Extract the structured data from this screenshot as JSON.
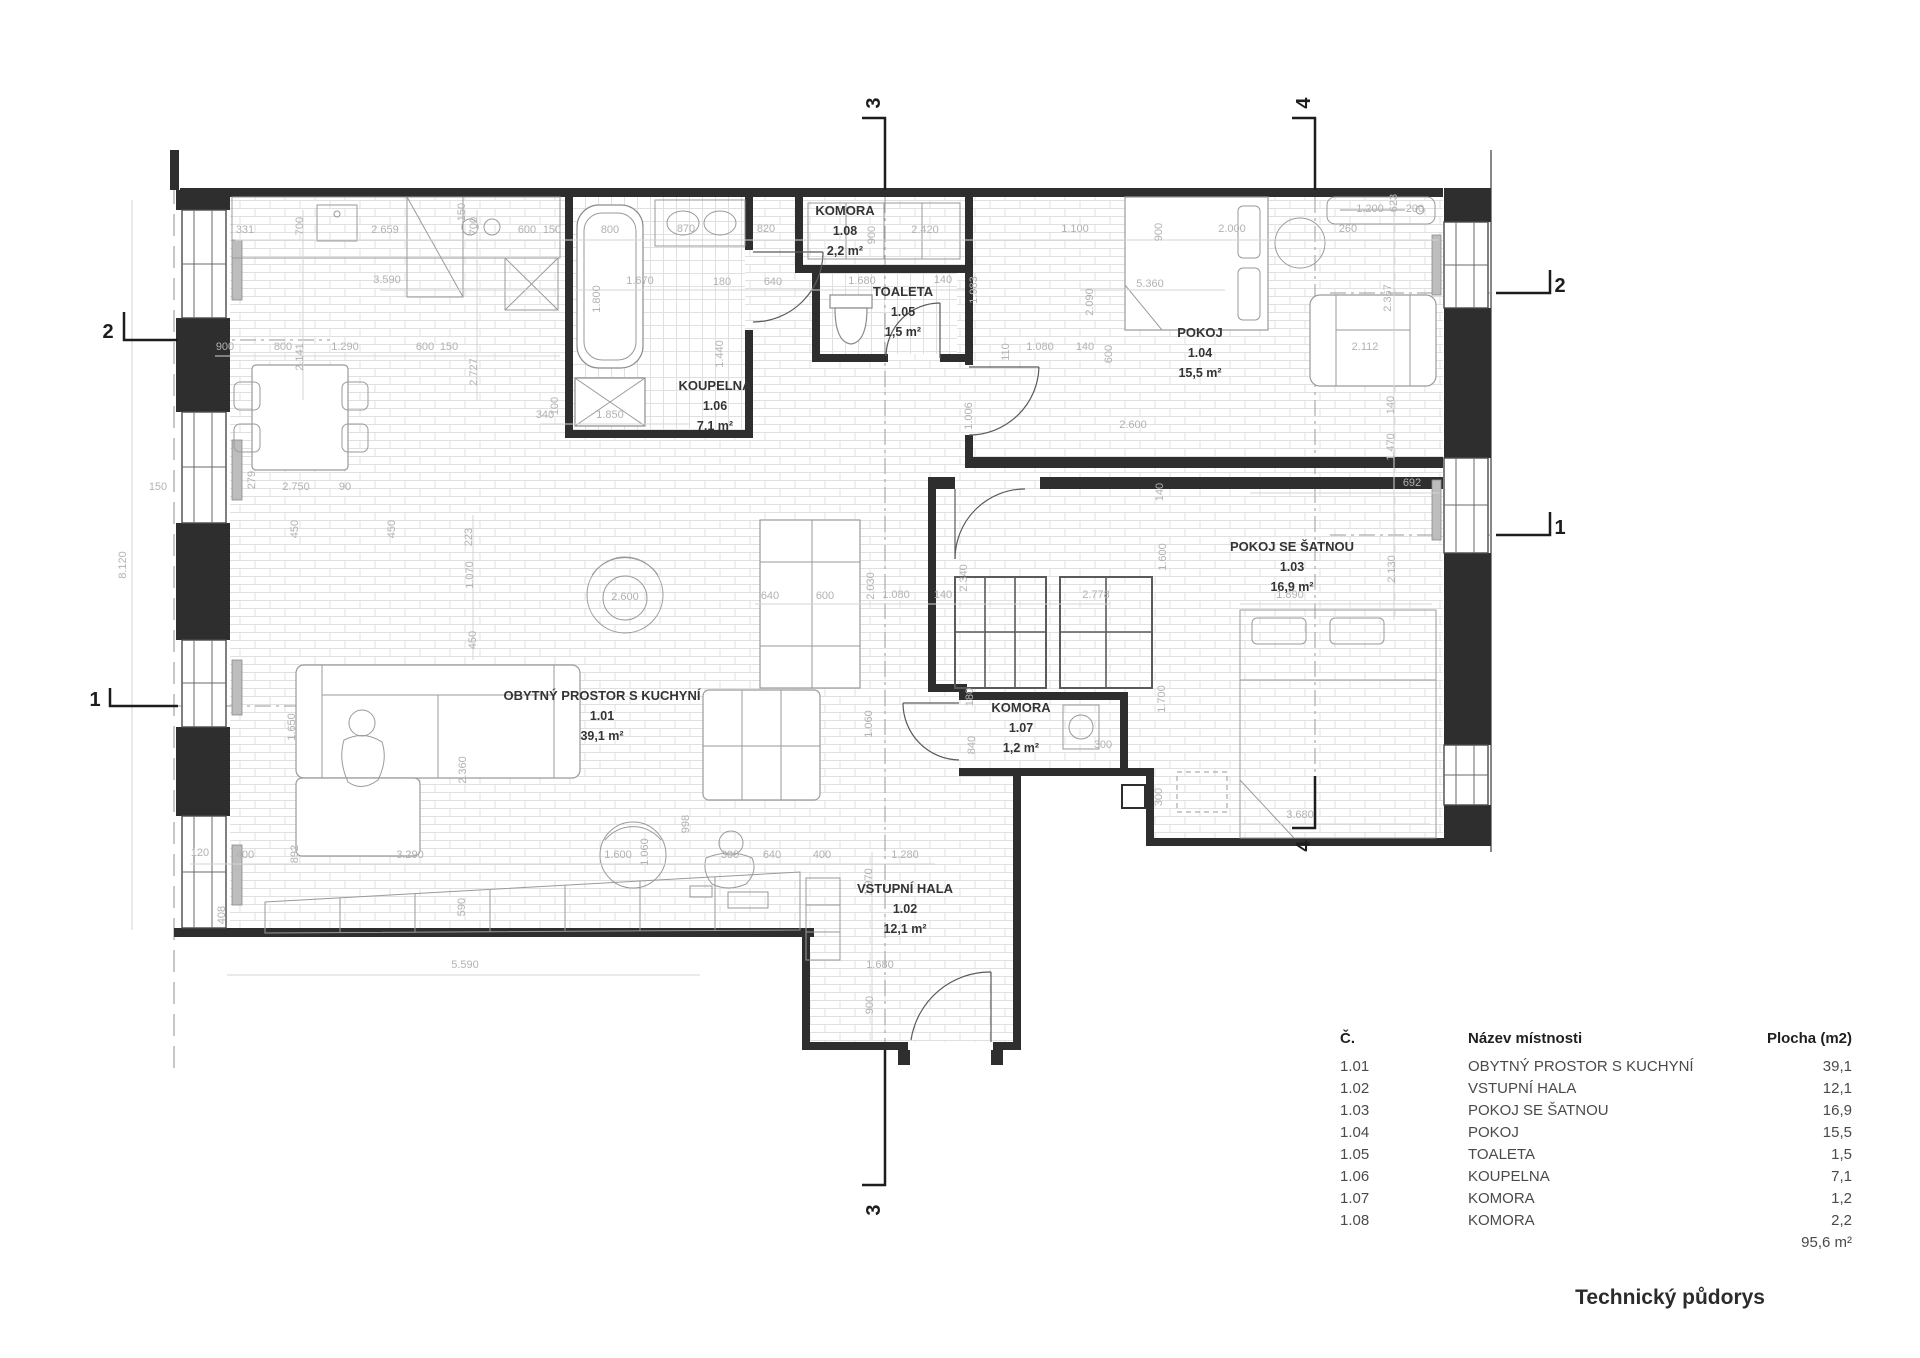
{
  "drawing": {
    "title": "Technický půdorys",
    "total_area": "95,6 m²"
  },
  "legend": {
    "headers": {
      "num": "Č.",
      "name": "Název místnosti",
      "area": "Plocha (m2)"
    },
    "rows": [
      {
        "num": "1.01",
        "name": "OBYTNÝ PROSTOR S KUCHYNÍ",
        "area": "39,1"
      },
      {
        "num": "1.02",
        "name": "VSTUPNÍ HALA",
        "area": "12,1"
      },
      {
        "num": "1.03",
        "name": "POKOJ SE ŠATNOU",
        "area": "16,9"
      },
      {
        "num": "1.04",
        "name": "POKOJ",
        "area": "15,5"
      },
      {
        "num": "1.05",
        "name": "TOALETA",
        "area": "1,5"
      },
      {
        "num": "1.06",
        "name": "KOUPELNA",
        "area": "7,1"
      },
      {
        "num": "1.07",
        "name": "KOMORA",
        "area": "1,2"
      },
      {
        "num": "1.08",
        "name": "KOMORA",
        "area": "2,2"
      }
    ]
  },
  "rooms": [
    {
      "id": "1.01",
      "name": "OBYTNÝ PROSTOR S KUCHYNÍ",
      "area": "39,1 m²",
      "x": 602,
      "y": 700
    },
    {
      "id": "1.02",
      "name": "VSTUPNÍ HALA",
      "area": "12,1 m²",
      "x": 905,
      "y": 893
    },
    {
      "id": "1.03",
      "name": "POKOJ SE ŠATNOU",
      "area": "16,9 m²",
      "x": 1292,
      "y": 551
    },
    {
      "id": "1.04",
      "name": "POKOJ",
      "area": "15,5 m²",
      "x": 1200,
      "y": 337
    },
    {
      "id": "1.05",
      "name": "TOALETA",
      "area": "1,5 m²",
      "x": 903,
      "y": 296
    },
    {
      "id": "1.06",
      "name": "KOUPELNA",
      "area": "7,1 m²",
      "x": 715,
      "y": 390
    },
    {
      "id": "1.07",
      "name": "KOMORA",
      "area": "1,2 m²",
      "x": 1021,
      "y": 712
    },
    {
      "id": "1.08",
      "name": "KOMORA",
      "area": "2,2 m²",
      "x": 845,
      "y": 215
    }
  ],
  "sections": [
    {
      "label": "2",
      "x": 108,
      "y": 338,
      "rot": 0
    },
    {
      "label": "1",
      "x": 95,
      "y": 706,
      "rot": 0
    },
    {
      "label": "2",
      "x": 1560,
      "y": 292,
      "rot": 0
    },
    {
      "label": "1",
      "x": 1560,
      "y": 534,
      "rot": 0
    },
    {
      "label": "3",
      "x": 880,
      "y": 103,
      "rot": 1
    },
    {
      "label": "4",
      "x": 1310,
      "y": 103,
      "rot": 1
    },
    {
      "label": "3",
      "x": 880,
      "y": 1210,
      "rot": 1
    },
    {
      "label": "4",
      "x": 1310,
      "y": 846,
      "rot": 1
    }
  ],
  "dims": [
    [
      "331",
      245,
      233,
      0
    ],
    [
      "700",
      303,
      226,
      1
    ],
    [
      "2.659",
      385,
      233,
      0
    ],
    [
      "700",
      477,
      226,
      1
    ],
    [
      "600",
      527,
      233,
      0
    ],
    [
      "150",
      552,
      233,
      0
    ],
    [
      "800",
      610,
      233,
      0
    ],
    [
      "870",
      686,
      232,
      0
    ],
    [
      "820",
      766,
      232,
      0
    ],
    [
      "900",
      875,
      235,
      1
    ],
    [
      "2.420",
      925,
      233,
      0
    ],
    [
      "1.100",
      1075,
      232,
      0
    ],
    [
      "900",
      1162,
      232,
      1
    ],
    [
      "2.000",
      1232,
      232,
      0
    ],
    [
      "260",
      1348,
      232,
      0
    ],
    [
      "1.200",
      1370,
      212,
      0
    ],
    [
      "623",
      1397,
      203,
      1
    ],
    [
      "200",
      1415,
      212,
      0
    ],
    [
      "3.590",
      387,
      283,
      0
    ],
    [
      "150",
      465,
      212,
      1
    ],
    [
      "1.670",
      640,
      284,
      0
    ],
    [
      "1.800",
      600,
      299,
      1
    ],
    [
      "180",
      722,
      285,
      0
    ],
    [
      "640",
      773,
      285,
      0
    ],
    [
      "1.680",
      862,
      284,
      0
    ],
    [
      "140",
      943,
      283,
      0
    ],
    [
      "1.983",
      977,
      290,
      1
    ],
    [
      "5.360",
      1150,
      287,
      0
    ],
    [
      "2.090",
      1093,
      302,
      1
    ],
    [
      "110",
      1009,
      352,
      1
    ],
    [
      "2.141",
      303,
      357,
      1
    ],
    [
      "2.727",
      477,
      372,
      1
    ],
    [
      "900",
      225,
      350,
      0
    ],
    [
      "800",
      283,
      350,
      0
    ],
    [
      "1.290",
      345,
      350,
      0
    ],
    [
      "600",
      425,
      350,
      0
    ],
    [
      "150",
      449,
      350,
      0
    ],
    [
      "340",
      545,
      418,
      0
    ],
    [
      "100",
      558,
      406,
      1
    ],
    [
      "1.850",
      610,
      418,
      0
    ],
    [
      "1.440",
      723,
      354,
      1
    ],
    [
      "1.080",
      1040,
      350,
      0
    ],
    [
      "140",
      1085,
      350,
      0
    ],
    [
      "600",
      1112,
      354,
      1
    ],
    [
      "2.600",
      1133,
      428,
      0
    ],
    [
      "2.367",
      1391,
      298,
      1
    ],
    [
      "2.112",
      1365,
      350,
      0
    ],
    [
      "140",
      1394,
      405,
      1
    ],
    [
      "150",
      158,
      490,
      0
    ],
    [
      "2.750",
      296,
      490,
      0
    ],
    [
      "279",
      255,
      480,
      1
    ],
    [
      "90",
      345,
      490,
      0
    ],
    [
      "450",
      298,
      529,
      1
    ],
    [
      "450",
      395,
      529,
      1
    ],
    [
      "223",
      472,
      537,
      1
    ],
    [
      "1.070",
      473,
      575,
      1
    ],
    [
      "450",
      476,
      640,
      1
    ],
    [
      "2.600",
      625,
      600,
      0
    ],
    [
      "640",
      770,
      599,
      0
    ],
    [
      "600",
      825,
      599,
      0
    ],
    [
      "2.030",
      874,
      586,
      1
    ],
    [
      "1.080",
      896,
      598,
      0
    ],
    [
      "140",
      943,
      598,
      0
    ],
    [
      "2.778",
      1096,
      598,
      0
    ],
    [
      "2.340",
      967,
      578,
      1
    ],
    [
      "1.006",
      972,
      416,
      1
    ],
    [
      "1.600",
      1166,
      557,
      1
    ],
    [
      "140",
      1163,
      492,
      1
    ],
    [
      "1.470",
      1394,
      447,
      1
    ],
    [
      "692",
      1412,
      486,
      0
    ],
    [
      "1.890",
      1290,
      598,
      0
    ],
    [
      "2.130",
      1395,
      569,
      1
    ],
    [
      "1.700",
      1165,
      699,
      1
    ],
    [
      "8.120",
      126,
      565,
      1
    ],
    [
      "1.650",
      295,
      727,
      1
    ],
    [
      "2.360",
      466,
      770,
      1
    ],
    [
      "1.060",
      648,
      852,
      1
    ],
    [
      "1.060",
      872,
      724,
      1
    ],
    [
      "998",
      689,
      824,
      1
    ],
    [
      "180",
      973,
      697,
      1
    ],
    [
      "840",
      975,
      745,
      1
    ],
    [
      "300",
      1103,
      748,
      0
    ],
    [
      "300",
      1162,
      797,
      1
    ],
    [
      "3.680",
      1300,
      818,
      0
    ],
    [
      "120",
      200,
      856,
      0
    ],
    [
      "400",
      245,
      858,
      0
    ],
    [
      "892",
      298,
      854,
      1
    ],
    [
      "3.290",
      410,
      858,
      0
    ],
    [
      "1.600",
      618,
      858,
      0
    ],
    [
      "300",
      730,
      858,
      0
    ],
    [
      "640",
      772,
      858,
      0
    ],
    [
      "400",
      822,
      858,
      0
    ],
    [
      "1.280",
      905,
      858,
      0
    ],
    [
      "1.970",
      872,
      882,
      1
    ],
    [
      "408",
      225,
      915,
      1
    ],
    [
      "590",
      465,
      907,
      1
    ],
    [
      "1.680",
      880,
      968,
      0
    ],
    [
      "900",
      873,
      1005,
      1
    ],
    [
      "5.590",
      465,
      968,
      0
    ]
  ]
}
